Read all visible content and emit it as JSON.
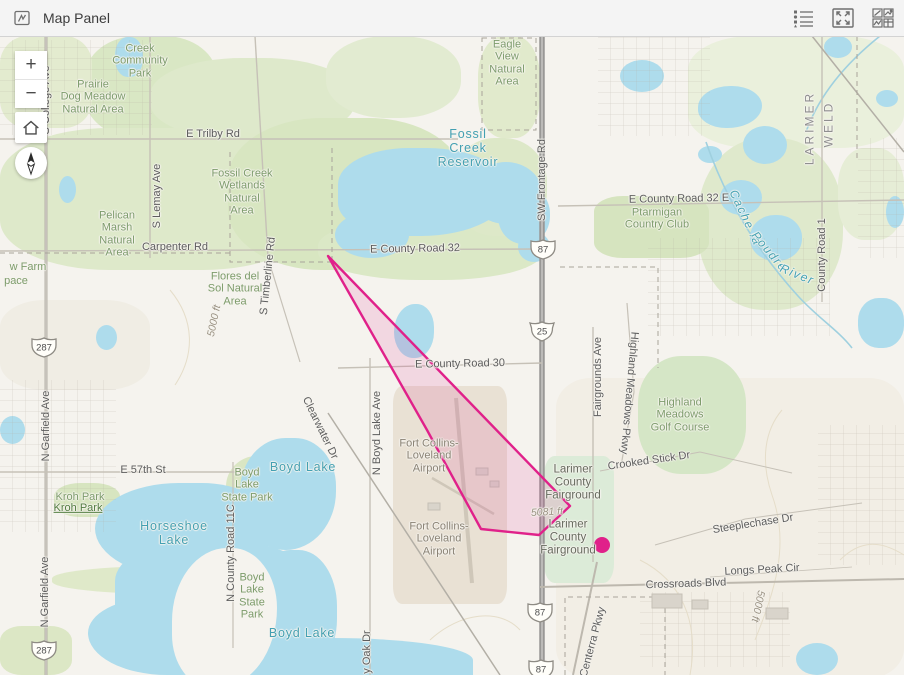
{
  "header": {
    "title": "Map Panel",
    "icons": [
      {
        "name": "legend-icon"
      },
      {
        "name": "fullscreen-icon"
      },
      {
        "name": "widget-grid-icon"
      }
    ]
  },
  "controls": {
    "zoom_in_label": "+",
    "zoom_out_label": "−",
    "home_tooltip": "Default map view",
    "compass_tooltip": "Reset compass orientation"
  },
  "colors": {
    "accent": "#e0218a",
    "polygon_fill": "rgba(224,33,138,0.13)",
    "water": "#aedcec",
    "green": "#dfe9cb",
    "background": "#f5f3ee",
    "road_major": "#999896",
    "header_bg": "#f4f4f4"
  },
  "map": {
    "tints": [
      [
        556,
        378,
        348,
        300,
        "#f2eee5",
        "10%"
      ],
      [
        0,
        300,
        150,
        90,
        "#f0ede4",
        "30%"
      ]
    ],
    "greens": [
      [
        85,
        36,
        132,
        102,
        "#d9e7c4",
        "40%"
      ],
      [
        0,
        36,
        92,
        92,
        "#e3ebcf",
        "30%"
      ],
      [
        150,
        58,
        205,
        82,
        "#dee9cb",
        "45%"
      ],
      [
        0,
        128,
        312,
        142,
        "#dee9ca",
        "35%"
      ],
      [
        228,
        118,
        235,
        152,
        "#d8e6c1",
        "40%"
      ],
      [
        318,
        218,
        225,
        62,
        "#dbe8c6",
        "45%"
      ],
      [
        452,
        138,
        95,
        98,
        "#dde8c8",
        "45%"
      ],
      [
        478,
        36,
        62,
        102,
        "#e1eacc",
        "40%"
      ],
      [
        688,
        36,
        216,
        112,
        "#eaf0dc",
        "30%"
      ],
      [
        698,
        138,
        145,
        172,
        "#dfe9cc",
        "45%"
      ],
      [
        838,
        148,
        66,
        92,
        "#e6edd6",
        "40%"
      ],
      [
        594,
        196,
        115,
        62,
        "#d6e4bf",
        "25%"
      ],
      [
        638,
        356,
        108,
        118,
        "#d5e6c6",
        "40%"
      ],
      [
        544,
        456,
        70,
        127,
        "#dcebd8",
        "15%"
      ],
      [
        54,
        483,
        66,
        34,
        "#d7e5c0",
        "40%"
      ],
      [
        226,
        456,
        68,
        68,
        "#dae6c3",
        "45%"
      ],
      [
        230,
        563,
        74,
        82,
        "#dae6c3",
        "45%"
      ],
      [
        52,
        566,
        255,
        28,
        "#dfe9c9",
        "45%"
      ],
      [
        0,
        626,
        72,
        49,
        "#dce7c5",
        "30%"
      ],
      [
        326,
        36,
        135,
        82,
        "#e2ebd1",
        "45%"
      ],
      [
        393,
        386,
        114,
        218,
        "#e9e1d4",
        "8%"
      ]
    ],
    "water": [
      [
        338,
        148,
        172,
        88,
        "46% 54% 58% 42%"
      ],
      [
        470,
        162,
        72,
        62,
        "50%"
      ],
      [
        335,
        212,
        74,
        46,
        "50%"
      ],
      [
        498,
        186,
        52,
        58,
        "48%"
      ],
      [
        518,
        232,
        32,
        30,
        "50%"
      ],
      [
        115,
        37,
        28,
        40,
        "45%"
      ],
      [
        59,
        176,
        17,
        27,
        "50%"
      ],
      [
        96,
        325,
        21,
        25,
        "50%"
      ],
      [
        0,
        416,
        25,
        28,
        "50%"
      ],
      [
        394,
        304,
        40,
        54,
        "55% 45% 50% 50%"
      ],
      [
        620,
        60,
        44,
        32,
        "50%"
      ],
      [
        698,
        86,
        64,
        42,
        "52% 48% 55% 45%"
      ],
      [
        743,
        126,
        44,
        38,
        "50%"
      ],
      [
        720,
        180,
        42,
        35,
        "50%"
      ],
      [
        750,
        215,
        52,
        46,
        "48%"
      ],
      [
        698,
        146,
        24,
        17,
        "50%"
      ],
      [
        824,
        36,
        28,
        22,
        "50%"
      ],
      [
        876,
        90,
        22,
        17,
        "50%"
      ],
      [
        858,
        298,
        46,
        50,
        "45%"
      ],
      [
        886,
        196,
        18,
        32,
        "50%"
      ],
      [
        95,
        483,
        175,
        95,
        "55% 45% 50% 60%"
      ],
      [
        115,
        540,
        205,
        105,
        "45% 55% 60% 40%"
      ],
      [
        88,
        598,
        145,
        77,
        "50% 50% 40% 60%"
      ],
      [
        240,
        438,
        96,
        112,
        "50% 45% 55% 50%"
      ],
      [
        252,
        550,
        85,
        125,
        "45%"
      ],
      [
        238,
        638,
        235,
        37,
        "40% 60% 0 0"
      ],
      [
        320,
        652,
        150,
        23,
        "50% 50% 0 0"
      ],
      [
        796,
        643,
        42,
        32,
        "50%"
      ]
    ],
    "land_carves": [
      [
        172,
        548,
        105,
        140,
        "55% 45% 60% 40%"
      ]
    ],
    "grids": [
      [
        0,
        40,
        152,
        95
      ],
      [
        598,
        36,
        112,
        100
      ],
      [
        648,
        238,
        182,
        98
      ],
      [
        0,
        380,
        116,
        152
      ],
      [
        818,
        425,
        86,
        140
      ],
      [
        858,
        138,
        46,
        120
      ],
      [
        640,
        592,
        150,
        75
      ]
    ],
    "streams": [
      {
        "p": "M706,142 C726,200 758,252 798,296 C818,318 838,330 852,348",
        "c": "#9fd0df",
        "w": 1.6
      },
      {
        "p": "M880,36 C850,60 820,92 806,132",
        "c": "#9fd0df",
        "w": 1.6
      }
    ],
    "contours": [
      {
        "p": "M755,640 C775,590 790,545 772,495 C760,460 765,430 782,410"
      },
      {
        "p": "M690,675 C700,620 680,580 640,560"
      },
      {
        "p": "M170,290 C195,320 195,355 175,385"
      },
      {
        "p": "M430,640 C460,612 500,608 520,630"
      },
      {
        "p": "M840,560 C860,540 880,540 904,555"
      }
    ],
    "roads": [
      {
        "x1": 456,
        "y1": 398,
        "x2": 472,
        "y2": 583,
        "w": 4,
        "c": "#cfc7b9"
      },
      {
        "x1": 432,
        "y1": 478,
        "x2": 494,
        "y2": 514,
        "w": 2.5,
        "c": "#cfc7b9"
      },
      {
        "x1": 542,
        "y1": 36,
        "x2": 542,
        "y2": 675,
        "w": 5.5,
        "c": "#999896"
      },
      {
        "x1": 542,
        "y1": 36,
        "x2": 542,
        "y2": 675,
        "w": 1.6,
        "c": "#c4c3c1"
      },
      {
        "x1": 46,
        "y1": 36,
        "x2": 46,
        "y2": 675,
        "w": 3,
        "c": "#b5b1a8"
      },
      {
        "x1": 46,
        "y1": 36,
        "x2": 46,
        "y2": 675,
        "w": 1,
        "c": "#d8d4cb"
      },
      {
        "x1": 150,
        "y1": 36,
        "x2": 150,
        "y2": 258,
        "w": 1.4
      },
      {
        "x1": 255,
        "y1": 36,
        "x2": 268,
        "y2": 258,
        "w": 1.4
      },
      {
        "x1": 268,
        "y1": 258,
        "x2": 300,
        "y2": 362,
        "w": 1.2
      },
      {
        "x1": 0,
        "y1": 139,
        "x2": 458,
        "y2": 139,
        "w": 1.4
      },
      {
        "x1": 0,
        "y1": 251,
        "x2": 540,
        "y2": 249,
        "w": 1.4
      },
      {
        "x1": 558,
        "y1": 206,
        "x2": 904,
        "y2": 200,
        "w": 1.4
      },
      {
        "x1": 338,
        "y1": 368,
        "x2": 542,
        "y2": 363,
        "w": 1.4
      },
      {
        "x1": 0,
        "y1": 472,
        "x2": 242,
        "y2": 472,
        "w": 1.4
      },
      {
        "x1": 540,
        "y1": 587,
        "x2": 904,
        "y2": 579,
        "w": 2,
        "c": "#bdb8ae"
      },
      {
        "x1": 370,
        "y1": 358,
        "x2": 370,
        "y2": 675,
        "w": 1.4
      },
      {
        "x1": 593,
        "y1": 327,
        "x2": 593,
        "y2": 562,
        "w": 1.4
      },
      {
        "x1": 597,
        "y1": 562,
        "x2": 573,
        "y2": 675,
        "w": 2,
        "c": "#bdb8ae"
      },
      {
        "x1": 627,
        "y1": 303,
        "x2": 634,
        "y2": 392,
        "w": 1.2
      },
      {
        "x1": 634,
        "y1": 392,
        "x2": 621,
        "y2": 466,
        "w": 1.2
      },
      {
        "x1": 822,
        "y1": 36,
        "x2": 822,
        "y2": 302,
        "w": 1.4
      },
      {
        "x1": 233,
        "y1": 462,
        "x2": 233,
        "y2": 648,
        "w": 1.2
      },
      {
        "x1": 812,
        "y1": 36,
        "x2": 904,
        "y2": 152,
        "w": 1.5,
        "c": "#b3afa6"
      },
      {
        "x1": 328,
        "y1": 413,
        "x2": 500,
        "y2": 675,
        "w": 1.5,
        "c": "#b3afa6"
      },
      {
        "x1": 600,
        "y1": 471,
        "x2": 700,
        "y2": 452,
        "w": 1
      },
      {
        "x1": 700,
        "y1": 452,
        "x2": 792,
        "y2": 473,
        "w": 1
      },
      {
        "x1": 655,
        "y1": 545,
        "x2": 745,
        "y2": 519,
        "w": 1
      },
      {
        "x1": 745,
        "y1": 519,
        "x2": 862,
        "y2": 503,
        "w": 1
      },
      {
        "x1": 710,
        "y1": 577,
        "x2": 852,
        "y2": 567,
        "w": 0.8
      }
    ],
    "dashes": [
      {
        "p": "M230,152 V262 H332"
      },
      {
        "p": "M482,38 H536 V130 H482 Z"
      },
      {
        "p": "M560,267 H658 V368"
      },
      {
        "p": "M565,675 V597 H665 V675"
      },
      {
        "p": "M857,36 V158"
      },
      {
        "p": "M0,253 H232"
      },
      {
        "p": "M332,148 V262"
      }
    ],
    "buildings": [
      [
        652,
        594,
        30,
        14
      ],
      [
        692,
        600,
        16,
        9
      ],
      [
        766,
        608,
        22,
        11
      ],
      [
        476,
        468,
        12,
        7
      ],
      [
        490,
        481,
        9,
        6
      ],
      [
        428,
        503,
        12,
        7
      ]
    ],
    "labels": [
      {
        "t": "Creek\nCommunity\nPark",
        "x": 140,
        "y": 61,
        "c": "g"
      },
      {
        "t": "Prairie\nDog Meadow\nNatural Area",
        "x": 93,
        "y": 97,
        "c": "g"
      },
      {
        "t": "E Trilby Rd",
        "x": 213,
        "y": 134,
        "c": "r"
      },
      {
        "t": "Eagle\nView\nNatural\nArea",
        "x": 507,
        "y": 63,
        "c": "g"
      },
      {
        "t": "Fossil\nCreek\nReservoir",
        "x": 468,
        "y": 148,
        "c": "w"
      },
      {
        "t": "Fossil Creek\nWetlands\nNatural\nArea",
        "x": 242,
        "y": 192,
        "c": "g"
      },
      {
        "t": "Pelican\nMarsh\nNatural\nArea",
        "x": 117,
        "y": 234,
        "c": "g"
      },
      {
        "t": "S Lemay Ave",
        "x": 157,
        "y": 196,
        "c": "r",
        "r": -90
      },
      {
        "t": "Carpenter Rd",
        "x": 175,
        "y": 247,
        "c": "r"
      },
      {
        "t": "S Timberline Rd",
        "x": 268,
        "y": 276,
        "c": "r",
        "r": -84
      },
      {
        "t": "Flores del\nSol Natural\nArea",
        "x": 235,
        "y": 289,
        "c": "g"
      },
      {
        "t": "5000 ft",
        "x": 215,
        "y": 321,
        "c": "e",
        "r": -78
      },
      {
        "t": "E County Road 32",
        "x": 415,
        "y": 249,
        "c": "r",
        "r": -1
      },
      {
        "t": "SW Frontage Rd",
        "x": 542,
        "y": 180,
        "c": "r",
        "r": -90
      },
      {
        "t": "E County Road 32 E",
        "x": 679,
        "y": 199,
        "c": "r",
        "r": -1
      },
      {
        "t": "Ptarmigan\nCountry Club",
        "x": 657,
        "y": 219,
        "c": "g"
      },
      {
        "t": "Cache la",
        "x": 745,
        "y": 218,
        "c": "wr",
        "r": 65
      },
      {
        "t": "Poudre",
        "x": 769,
        "y": 252,
        "c": "wr",
        "r": 50
      },
      {
        "t": "River",
        "x": 797,
        "y": 275,
        "c": "wr",
        "r": 22
      },
      {
        "t": "LARIMER",
        "x": 810,
        "y": 128,
        "c": "cty",
        "r": -90
      },
      {
        "t": "WELD",
        "x": 829,
        "y": 124,
        "c": "cty",
        "r": -90
      },
      {
        "t": "County Road 1",
        "x": 822,
        "y": 255,
        "c": "r",
        "r": -90
      },
      {
        "t": "E County Road 30",
        "x": 460,
        "y": 364,
        "c": "r",
        "r": -1
      },
      {
        "t": "N Boyd Lake Ave",
        "x": 377,
        "y": 433,
        "c": "r",
        "r": -90
      },
      {
        "t": "Clearwater Dr",
        "x": 320,
        "y": 428,
        "c": "r",
        "r": 64
      },
      {
        "t": "Boyd Lake",
        "x": 303,
        "y": 467,
        "c": "w"
      },
      {
        "t": "Fort Collins-\nLoveland\nAirport",
        "x": 429,
        "y": 456,
        "c": "a"
      },
      {
        "t": "Fort Collins-\nLoveland\nAirport",
        "x": 439,
        "y": 539,
        "c": "a"
      },
      {
        "t": "Larimer\nCounty\nFairground",
        "x": 573,
        "y": 483,
        "c": "f"
      },
      {
        "t": "5081 ft",
        "x": 547,
        "y": 513,
        "c": "e",
        "r": -3
      },
      {
        "t": "Larimer\nCounty\nFairground",
        "x": 568,
        "y": 538,
        "c": "f"
      },
      {
        "t": "Fairgrounds Ave",
        "x": 598,
        "y": 377,
        "c": "r",
        "r": -90
      },
      {
        "t": "Highland Meadows Pkwy",
        "x": 629,
        "y": 393,
        "c": "r",
        "r": 95
      },
      {
        "t": "Highland\nMeadows\nGolf Course",
        "x": 680,
        "y": 415,
        "c": "g"
      },
      {
        "t": "Crooked Stick Dr",
        "x": 649,
        "y": 461,
        "c": "r",
        "r": -8
      },
      {
        "t": "Steeplechase Dr",
        "x": 753,
        "y": 524,
        "c": "r",
        "r": -9
      },
      {
        "t": "Longs Peak Cir",
        "x": 762,
        "y": 570,
        "c": "r",
        "r": -3
      },
      {
        "t": "Crossroads Blvd",
        "x": 686,
        "y": 584,
        "c": "r",
        "r": -2
      },
      {
        "t": "5000 ft",
        "x": 757,
        "y": 606,
        "c": "e",
        "r": 102
      },
      {
        "t": "Centerra Pkwy",
        "x": 593,
        "y": 642,
        "c": "r",
        "r": -75
      },
      {
        "t": "N Garfield Ave",
        "x": 46,
        "y": 426,
        "c": "r",
        "r": -90
      },
      {
        "t": "N Garfield Ave",
        "x": 45,
        "y": 592,
        "c": "r",
        "r": -90
      },
      {
        "t": "E 57th St",
        "x": 143,
        "y": 470,
        "c": "r"
      },
      {
        "t": "Kroh Park",
        "x": 80,
        "y": 497,
        "c": "g"
      },
      {
        "t": "Kroh Park",
        "x": 78,
        "y": 508,
        "c": "gd"
      },
      {
        "t": "Horseshoe\nLake",
        "x": 174,
        "y": 533,
        "c": "w"
      },
      {
        "t": "Boyd\nLake\nState Park",
        "x": 247,
        "y": 485,
        "c": "g"
      },
      {
        "t": "Boyd\nLake\nState\nPark",
        "x": 252,
        "y": 596,
        "c": "g"
      },
      {
        "t": "Boyd Lake",
        "x": 302,
        "y": 633,
        "c": "w"
      },
      {
        "t": "N County Road 11C",
        "x": 231,
        "y": 553,
        "c": "r",
        "r": -90
      },
      {
        "t": "w Farm",
        "x": 28,
        "y": 267,
        "c": "g"
      },
      {
        "t": "pace",
        "x": 16,
        "y": 281,
        "c": "g"
      },
      {
        "t": "y Oak Dr",
        "x": 367,
        "y": 652,
        "c": "r",
        "r": -90
      },
      {
        "t": "S College Ave",
        "x": 46,
        "y": 100,
        "c": "r",
        "r": -90
      }
    ],
    "shields": [
      {
        "k": "us",
        "t": "87",
        "x": 543,
        "y": 249
      },
      {
        "k": "i",
        "t": "25",
        "x": 542,
        "y": 331
      },
      {
        "k": "us",
        "t": "87",
        "x": 540,
        "y": 612
      },
      {
        "k": "us",
        "t": "87",
        "x": 541,
        "y": 669
      },
      {
        "k": "us",
        "t": "287",
        "x": 44,
        "y": 347
      },
      {
        "k": "us",
        "t": "287",
        "x": 44,
        "y": 650
      }
    ],
    "polygon": {
      "stroke": "#e0218a",
      "fill": "rgba(224,33,138,0.13)",
      "stroke_width": 2.4,
      "points": [
        [
          328,
          256
        ],
        [
          427,
          430
        ],
        [
          481,
          529
        ],
        [
          539,
          535
        ],
        [
          570,
          506
        ]
      ]
    },
    "point": {
      "x": 602,
      "y": 545,
      "r": 8,
      "color": "#e0218a"
    }
  }
}
